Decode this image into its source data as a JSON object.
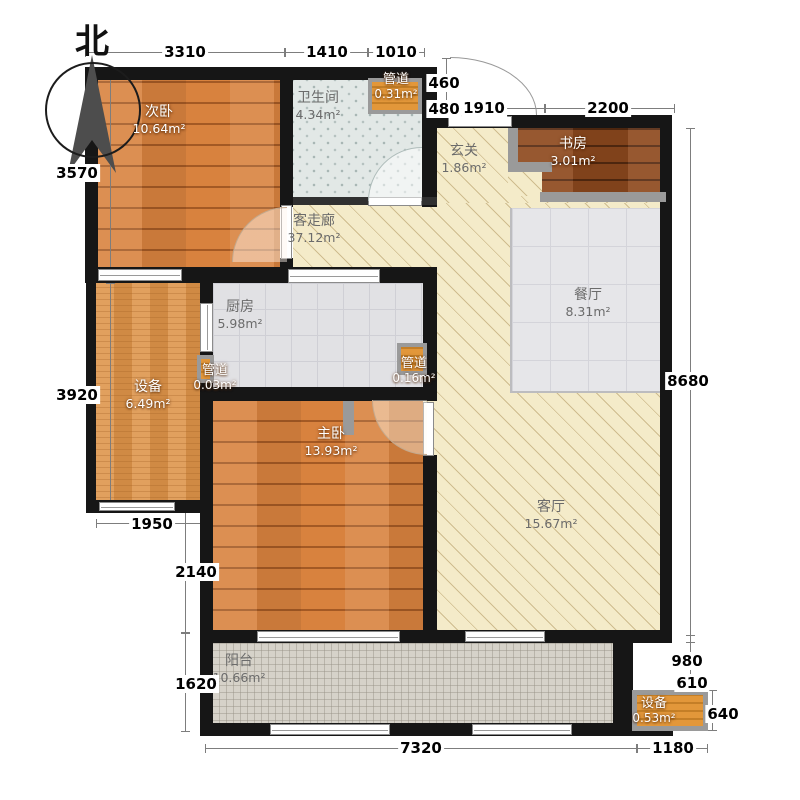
{
  "compass": {
    "north_label": "北"
  },
  "rooms": {
    "ciwo": {
      "name": "次卧",
      "area": "10.64m²"
    },
    "weishengjian": {
      "name": "卫生间",
      "area": "4.34m²"
    },
    "guandao_top": {
      "name": "管道",
      "area": "0.31m²"
    },
    "xuanguan": {
      "name": "玄关",
      "area": "1.86m²"
    },
    "shufang": {
      "name": "书房",
      "area": "3.01m²"
    },
    "zoulang": {
      "name": "客走廊",
      "area": "37.12m²"
    },
    "chufang": {
      "name": "厨房",
      "area": "5.98m²"
    },
    "canting": {
      "name": "餐厅",
      "area": "8.31m²"
    },
    "shebei_left": {
      "name": "设备",
      "area": "6.49m²"
    },
    "guandao_left": {
      "name": "管道",
      "area": "0.03m²"
    },
    "guandao_right": {
      "name": "管道",
      "area": "0.16m²"
    },
    "zhuwo": {
      "name": "主卧",
      "area": "13.93m²"
    },
    "keting": {
      "name": "客厅",
      "area": "15.67m²"
    },
    "yangtai": {
      "name": "阳台",
      "area": "10.66m²"
    },
    "shebei_br": {
      "name": "设备",
      "area": "0.53m²"
    }
  },
  "dimensions": {
    "top_3310": "3310",
    "top_1410": "1410",
    "top_1010": "1010",
    "tr_460": "460",
    "tr_480": "480",
    "tr_1910": "1910",
    "tr_2200": "2200",
    "left_3570": "3570",
    "left_3920": "3920",
    "left_1950": "1950",
    "left_2140": "2140",
    "left_1620": "1620",
    "right_8680": "8680",
    "right_980": "980",
    "right_610": "610",
    "right_640": "640",
    "bottom_7320": "7320",
    "bottom_1180": "1180"
  }
}
